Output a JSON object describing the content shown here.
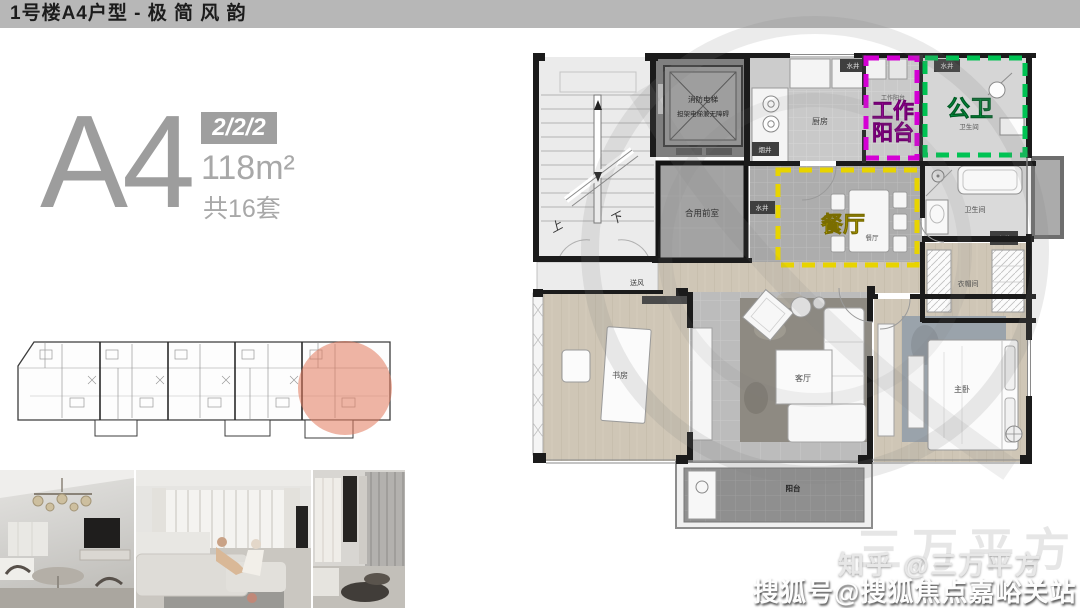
{
  "header": {
    "title": "1号楼A4户型 - 极 简 风 韵"
  },
  "unit": {
    "code": "A4",
    "spec": "2/2/2",
    "area": "118m²",
    "count": "共16套"
  },
  "colors": {
    "highlight_magenta": "#cc00cc",
    "highlight_green": "#00b84e",
    "highlight_yellow": "#e6d200",
    "mini_plan_circle": "#e2795b"
  },
  "floor_plan": {
    "highlights": {
      "work_balcony": {
        "line1": "工作",
        "line2": "阳台"
      },
      "public_bath": {
        "text": "公卫"
      },
      "dining": {
        "text": "餐厅"
      }
    },
    "labels": {
      "up": "上",
      "down": "下",
      "elevator_line1": "消防电梯",
      "elevator_line2": "担架电梯兼无障碍",
      "lobby": "合用前室",
      "kitchen": "厨房",
      "smoke_shaft": "烟井",
      "water_shaft": "水井",
      "work_balcony_small": "工作阳台",
      "bathroom": "卫生间",
      "dining_small": "餐厅",
      "air_supply": "送风",
      "study": "书房",
      "living_room": "客厅",
      "master_bedroom": "主卧",
      "closet": "衣帽间",
      "balcony": "阳台"
    }
  },
  "watermarks": {
    "ghost_text": "三万平方",
    "zhihu": "知乎 @三万平方",
    "sohu": "搜狐号@搜狐焦点嘉峪关站"
  }
}
